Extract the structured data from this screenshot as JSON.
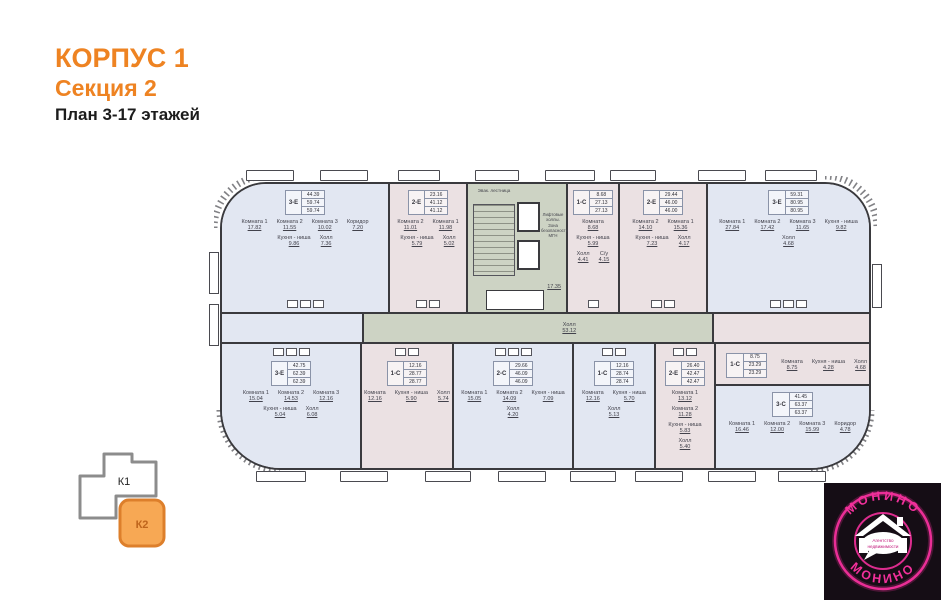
{
  "header": {
    "korpus": "КОРПУС 1",
    "sektsiya": "Секция 2",
    "plan": "План 3-17 этажей"
  },
  "colors": {
    "accent": "#EE8322",
    "unit_blue": "#E2E7F2",
    "unit_pink": "#EBE1E3",
    "core_green": "#CDD3C4",
    "wall": "#3A3A3E",
    "logo_pink": "#F2309B",
    "logo_bg": "#150D15",
    "k1_border": "#8C8C8C",
    "k2_fill": "#F7A854",
    "k2_border": "#DD7F2B",
    "k2_text": "#BF651C"
  },
  "plan": {
    "corridor": {
      "name": "Холл",
      "area": "53.12"
    },
    "core": {
      "stairs": "Эвак. лестница",
      "elevators": "Лифтовые холлы. Зона безопасности МГН",
      "area": "17.35"
    },
    "units": [
      {
        "type": "3-Е",
        "table": [
          "44.39",
          "59.74",
          "59.74"
        ],
        "rooms": [
          {
            "n": "Комната 1",
            "a": "17.82"
          },
          {
            "n": "Комната 2",
            "a": "11.55"
          },
          {
            "n": "Комната 3",
            "a": "10.02"
          },
          {
            "n": "Коридор",
            "a": "7.20"
          },
          {
            "n": "Кухня - ниша",
            "a": "9.86"
          },
          {
            "n": "Холл",
            "a": "7.36"
          }
        ]
      },
      {
        "type": "2-Е",
        "table": [
          "23.16",
          "41.12",
          "41.12"
        ],
        "rooms": [
          {
            "n": "Комната 2",
            "a": "11.01"
          },
          {
            "n": "Комната 1",
            "a": "11.98"
          },
          {
            "n": "Кухня - ниша",
            "a": "5.79"
          },
          {
            "n": "Холл",
            "a": "5.02"
          }
        ]
      },
      {
        "type": "1-С",
        "table": [
          "8.68",
          "27.13",
          "27.13"
        ],
        "rooms": [
          {
            "n": "Комната",
            "a": "8.68"
          },
          {
            "n": "Кухня - ниша",
            "a": "5.99"
          },
          {
            "n": "Холл",
            "a": "4.41"
          },
          {
            "n": "С/у",
            "a": "4.15"
          }
        ]
      },
      {
        "type": "2-Е",
        "table": [
          "29.44",
          "46.00",
          "46.00"
        ],
        "rooms": [
          {
            "n": "Комната 2",
            "a": "14.10"
          },
          {
            "n": "Комната 1",
            "a": "15.36"
          },
          {
            "n": "Кухня - ниша",
            "a": "7.23"
          },
          {
            "n": "Холл",
            "a": "4.17"
          }
        ]
      },
      {
        "type": "3-Е",
        "table": [
          "59.31",
          "80.95",
          "80.95"
        ],
        "rooms": [
          {
            "n": "Комната 1",
            "a": "27.84"
          },
          {
            "n": "Комната 2",
            "a": "17.42"
          },
          {
            "n": "Комната 3",
            "a": "11.65"
          },
          {
            "n": "Кухня - ниша",
            "a": "9.82"
          },
          {
            "n": "Холл",
            "a": "4.68"
          }
        ]
      },
      {
        "type": "3-Е",
        "table": [
          "42.75",
          "62.39",
          "62.39"
        ],
        "rooms": [
          {
            "n": "Комната 1",
            "a": "15.04"
          },
          {
            "n": "Комната 2",
            "a": "14.53"
          },
          {
            "n": "Комната 3",
            "a": "12.16"
          },
          {
            "n": "Кухня - ниша",
            "a": "5.04"
          },
          {
            "n": "Холл",
            "a": "6.08"
          }
        ]
      },
      {
        "type": "1-С",
        "table": [
          "12.16",
          "28.77",
          "28.77"
        ],
        "rooms": [
          {
            "n": "Комната",
            "a": "12.16"
          },
          {
            "n": "Кухня - ниша",
            "a": "5.90"
          },
          {
            "n": "Холл",
            "a": "5.74"
          }
        ]
      },
      {
        "type": "2-С",
        "table": [
          "29.66",
          "46.09",
          "46.09"
        ],
        "rooms": [
          {
            "n": "Комната 1",
            "a": "15.05"
          },
          {
            "n": "Комната 2",
            "a": "14.09"
          },
          {
            "n": "Кухня - ниша",
            "a": "7.09"
          },
          {
            "n": "Холл",
            "a": "4.20"
          }
        ]
      },
      {
        "type": "1-С",
        "table": [
          "12.16",
          "28.74",
          "28.74"
        ],
        "rooms": [
          {
            "n": "Комната",
            "a": "12.16"
          },
          {
            "n": "Кухня - ниша",
            "a": "5.70"
          },
          {
            "n": "Холл",
            "a": "5.13"
          }
        ]
      },
      {
        "type": "2-Е",
        "table": [
          "26.40",
          "42.47",
          "42.47"
        ],
        "rooms": [
          {
            "n": "Комната 1",
            "a": "13.12"
          },
          {
            "n": "Комната 2",
            "a": "11.28"
          },
          {
            "n": "Кухня - ниша",
            "a": "5.83"
          },
          {
            "n": "Холл",
            "a": "5.40"
          }
        ]
      },
      {
        "type": "1-С",
        "table": [
          "8.75",
          "23.29",
          "23.29"
        ],
        "rooms": [
          {
            "n": "Комната",
            "a": "8.75"
          },
          {
            "n": "Кухня - ниша",
            "a": "4.28"
          },
          {
            "n": "Холл",
            "a": "4.68"
          }
        ]
      },
      {
        "type": "3-С",
        "table": [
          "41.45",
          "63.37",
          "63.37"
        ],
        "rooms": [
          {
            "n": "Комната 1",
            "a": "16.46"
          },
          {
            "n": "Комната 2",
            "a": "12.00"
          },
          {
            "n": "Комната 3",
            "a": "15.99"
          },
          {
            "n": "Коридор",
            "a": "4.78"
          }
        ]
      }
    ]
  },
  "keyplan": {
    "k1_label": "К1",
    "k2_label": "К2"
  },
  "logo": {
    "brand_top": "МОНИНО",
    "brand_bottom": "МОНИНО",
    "tagline1": "Агентство",
    "tagline2": "недвижимости"
  }
}
